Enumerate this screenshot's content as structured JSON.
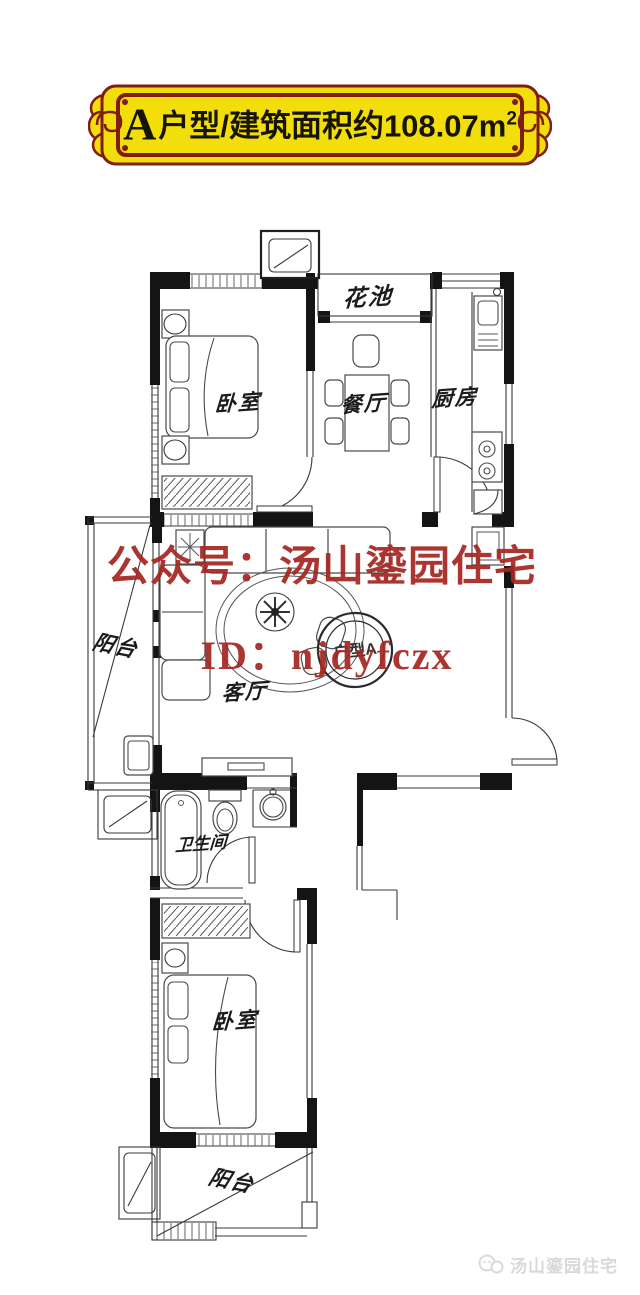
{
  "title": {
    "prefix_letter": "A",
    "body": "户型/建筑面积约108.07m",
    "superscript": "2"
  },
  "banner": {
    "background": "#F2DE0B",
    "border": "#7E1D10",
    "text_color": "#171400"
  },
  "rooms": [
    {
      "id": "bedroom-top",
      "label": "卧室"
    },
    {
      "id": "flower-bed",
      "label": "花池"
    },
    {
      "id": "dining",
      "label": "餐厅"
    },
    {
      "id": "kitchen",
      "label": "厨房"
    },
    {
      "id": "balcony-left",
      "label": "阳台"
    },
    {
      "id": "living",
      "label": "客厅"
    },
    {
      "id": "bathroom",
      "label": "卫生间"
    },
    {
      "id": "bedroom-bottom",
      "label": "卧室"
    },
    {
      "id": "balcony-bottom",
      "label": "阳台"
    }
  ],
  "watermark": {
    "line1": "公众号：汤山鎏园住宅",
    "line2": "ID：njdyfczx",
    "stamp_text": "户型A",
    "color": "#A52722"
  },
  "footer": {
    "brand": "汤山鎏园住宅",
    "color": "#D9D9D9"
  },
  "plan": {
    "line_color": "#1f1f1f"
  }
}
